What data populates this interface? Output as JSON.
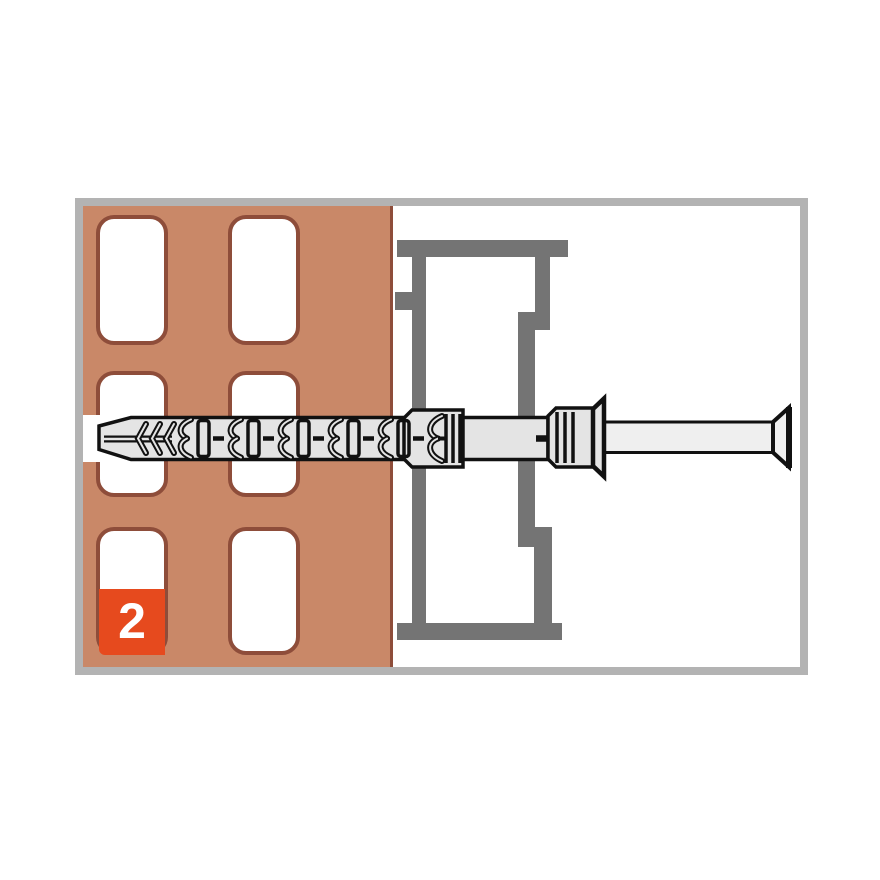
{
  "step_badge": {
    "label": "2"
  },
  "colors": {
    "panel_border": "#b3b3b3",
    "brick": "#c98868",
    "hole_outline": "#8e4d3a",
    "frame_profile": "#747474",
    "plug_fill": "#e4e4e4",
    "plug_outline": "#111111",
    "screw_fill": "#efefef",
    "badge_bg": "#e64a1e",
    "badge_text": "#ffffff"
  }
}
